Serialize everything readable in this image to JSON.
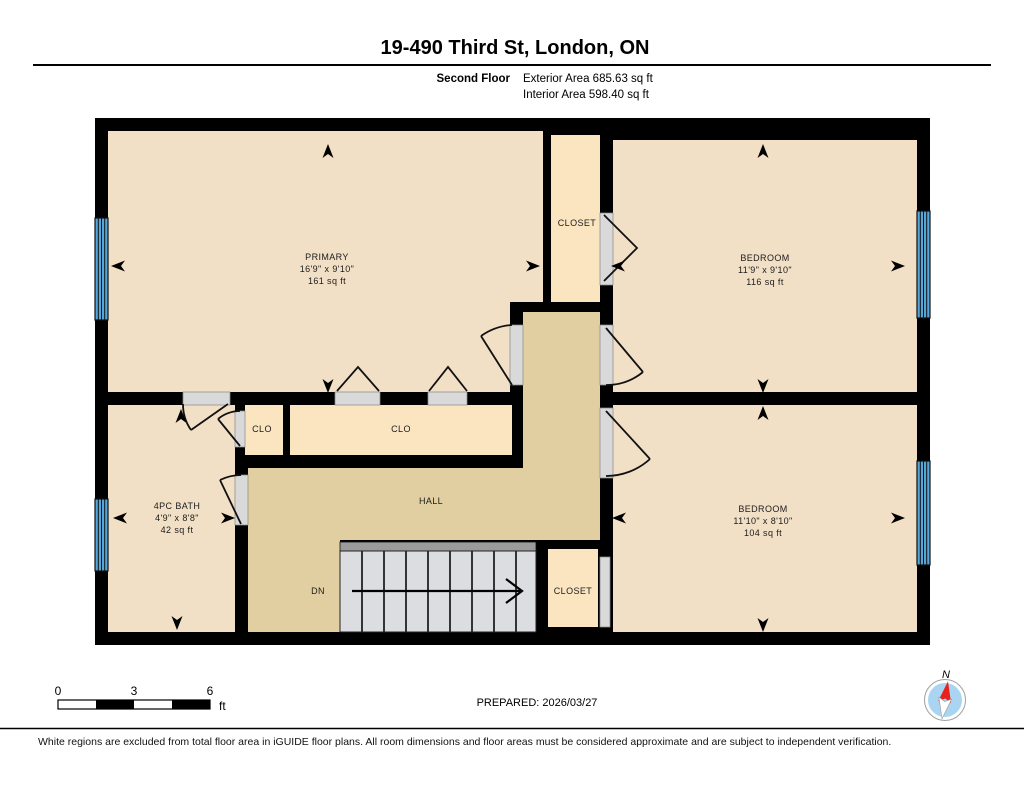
{
  "header": {
    "title": "19-490 Third St, London, ON",
    "floor_label": "Second Floor",
    "exterior_area": "Exterior Area 685.63 sq ft",
    "interior_area": "Interior Area 598.40 sq ft"
  },
  "rooms": {
    "primary": {
      "name": "PRIMARY",
      "dims": "16'9\" x 9'10\"",
      "area": "161 sq ft"
    },
    "bedroom_top": {
      "name": "BEDROOM",
      "dims": "11'9\" x 9'10\"",
      "area": "116 sq ft"
    },
    "bedroom_bottom": {
      "name": "BEDROOM",
      "dims": "11'10\" x 8'10\"",
      "area": "104 sq ft"
    },
    "bath": {
      "name": "4PC BATH",
      "dims": "4'9\" x 8'8\"",
      "area": "42 sq ft"
    },
    "closet_top": {
      "name": "CLOSET"
    },
    "closet_bottom": {
      "name": "CLOSET"
    },
    "clo_small": {
      "name": "CLO"
    },
    "clo_large": {
      "name": "CLO"
    },
    "hall": {
      "name": "HALL"
    },
    "stairs": {
      "label": "DN"
    }
  },
  "scale_bar": {
    "tick_0": "0",
    "tick_3": "3",
    "tick_6": "6",
    "unit": "ft"
  },
  "prepared_label": "PREPARED: 2026/03/27",
  "compass": {
    "north_label": "N"
  },
  "footer_note": "White regions are excluded from total floor area in iGUIDE floor plans. All room dimensions and floor areas must be considered approximate and are subject to independent verification.",
  "colors": {
    "wall": "#000000",
    "room_fill": "#f1dfc6",
    "closet_fill": "#fbe5c1",
    "hall_fill": "#e2cfa1",
    "stair_fill": "#dcdde1",
    "stair_rail": "#9b9b9b",
    "door_opening": "#d9d9d9",
    "window_blue": "#55a7d9",
    "compass_blue": "#a9d5f3",
    "needle_red": "#e8211d"
  }
}
